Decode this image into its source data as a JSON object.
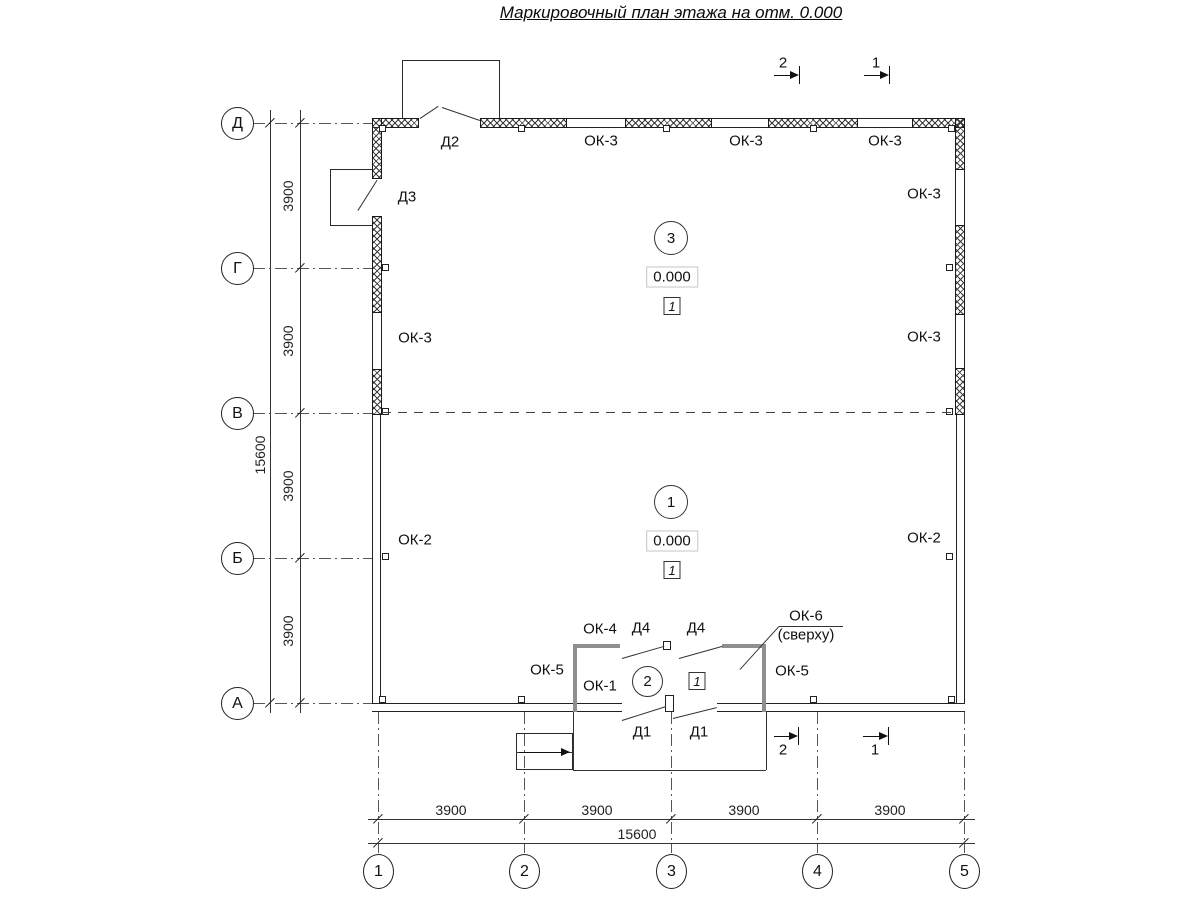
{
  "title": "Маркировочный план этажа на отм. 0.000",
  "axes": {
    "vertical": [
      "Д",
      "Г",
      "В",
      "Б",
      "А"
    ],
    "horizontal": [
      "1",
      "2",
      "3",
      "4",
      "5"
    ]
  },
  "dims": {
    "bay": "3900",
    "total": "15600"
  },
  "elevation": "0.000",
  "rooms": {
    "r1": "1",
    "r2": "2",
    "r3": "3",
    "floor_type": "1"
  },
  "windows": {
    "ok1": "ОК-1",
    "ok2": "ОК-2",
    "ok3": "ОК-3",
    "ok4": "ОК-4",
    "ok5": "ОК-5",
    "ok6": "ОК-6",
    "ok6_note": "(сверху)"
  },
  "doors": {
    "d1": "Д1",
    "d2": "Д2",
    "d3": "Д3",
    "d4": "Д4"
  },
  "sections": {
    "s1": "1",
    "s2": "2"
  }
}
